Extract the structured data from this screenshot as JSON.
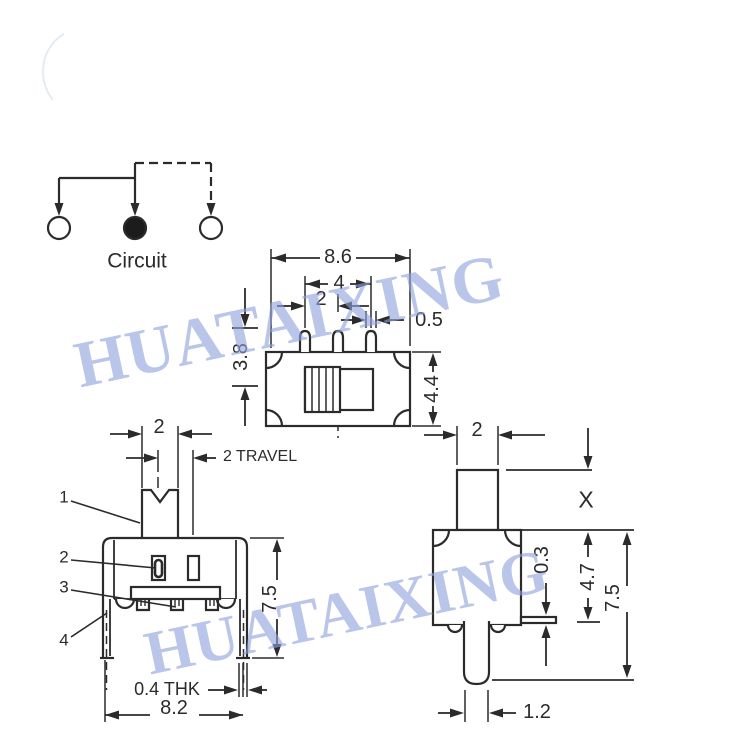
{
  "watermark": {
    "text": "HUATAIXING",
    "color": "#8fa2dd"
  },
  "circuit_diagram": {
    "label": "Circuit"
  },
  "top_view": {
    "dim_overall_width": "8.6",
    "dim_outer_pin_span": "4",
    "dim_pin_pitch": "2",
    "dim_pin_width": "0.5",
    "dim_pin_length": "3.8",
    "dim_body_depth": "4.4"
  },
  "front_view": {
    "dim_knob_width": "2",
    "dim_travel": "2 TRAVEL",
    "dim_height": "7.5",
    "dim_bracket_thickness": "0.4 THK",
    "dim_overall_width": "8.2",
    "callouts": [
      "1",
      "2",
      "3",
      "4"
    ]
  },
  "side_view": {
    "dim_knob_width": "2",
    "dim_knob_height": "X",
    "dim_flange_thickness": "0.3",
    "dim_body_height": "4.7",
    "dim_overall_height": "7.5",
    "dim_terminal_width": "1.2"
  }
}
